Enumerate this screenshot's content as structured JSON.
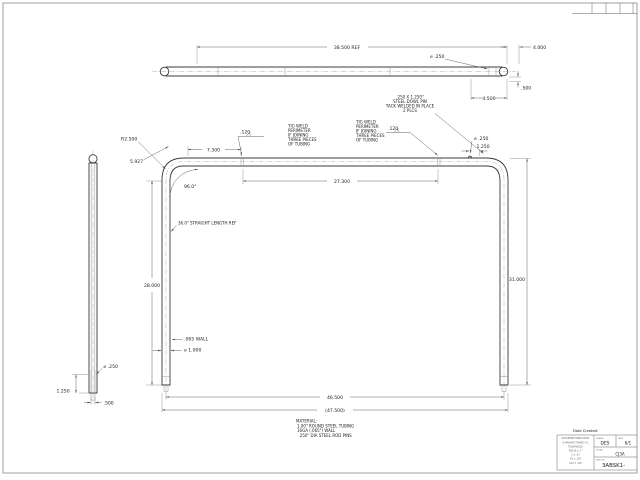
{
  "top_view": {
    "overall_length": "38.500 REF",
    "pin_dia": "⌀ .250",
    "end_dim": "4.000",
    "offset_dim": ".500",
    "pin_loc": "4.500"
  },
  "front_view": {
    "corner_radius": "R2.500",
    "diag_dim": "5.927",
    "tangent_dim": "7.300",
    "bend_angle": "96.0°",
    "joint_span": "27.300",
    "pin_dia": "⌀ .250",
    "pin_loc": "1.250",
    "height": "31.000",
    "leg_length": "28.000",
    "straight_note": "36.0\" STRAIGHT LENGTH REF",
    "wall": ".065 WALL",
    "tube_dia": "⌀ 1.000",
    "inner_width": "46.500",
    "outer_width": "(47.500)",
    "weld_size_left": ".120",
    "weld_size_right": ".120"
  },
  "side_view": {
    "pin_dia": "⌀ .250",
    "pin_engagement": "1.250",
    "pin_width": ".500"
  },
  "notes": {
    "dome_pin": [
      ".250 X 1.250\"",
      "STEEL DOWL PIN",
      "TACK WELDED IN PLACE",
      "2 PLCS"
    ],
    "weld": [
      "TIG WELD",
      "PERIMETER",
      "IF JOINING",
      "THREE PIECES",
      "OF TUBING"
    ],
    "material": [
      "MATERIAL:",
      "1.00\" ROUND STEEL TUBING",
      "16GA (.065\") WALL",
      ".250\" DIA STEEL ROD PINS"
    ]
  },
  "title_block": {
    "date_created": "Date Created:",
    "company": [
      "WOLVERINE FABRICATING",
      "& MANUFACTURING CO.",
      "TOLERANCES:",
      "ANGLE ± 1°",
      "X ± .03",
      "XX ± .010",
      "XXX ± .005"
    ],
    "drawn_label": "DRAWN",
    "drawn": "DES",
    "date_label": "DATE",
    "date": "6/1",
    "detail_label": "DETAIL",
    "detail": "CJ3A",
    "dwg_label": "DWG NO",
    "dwg_number": "3ABSK1-"
  }
}
